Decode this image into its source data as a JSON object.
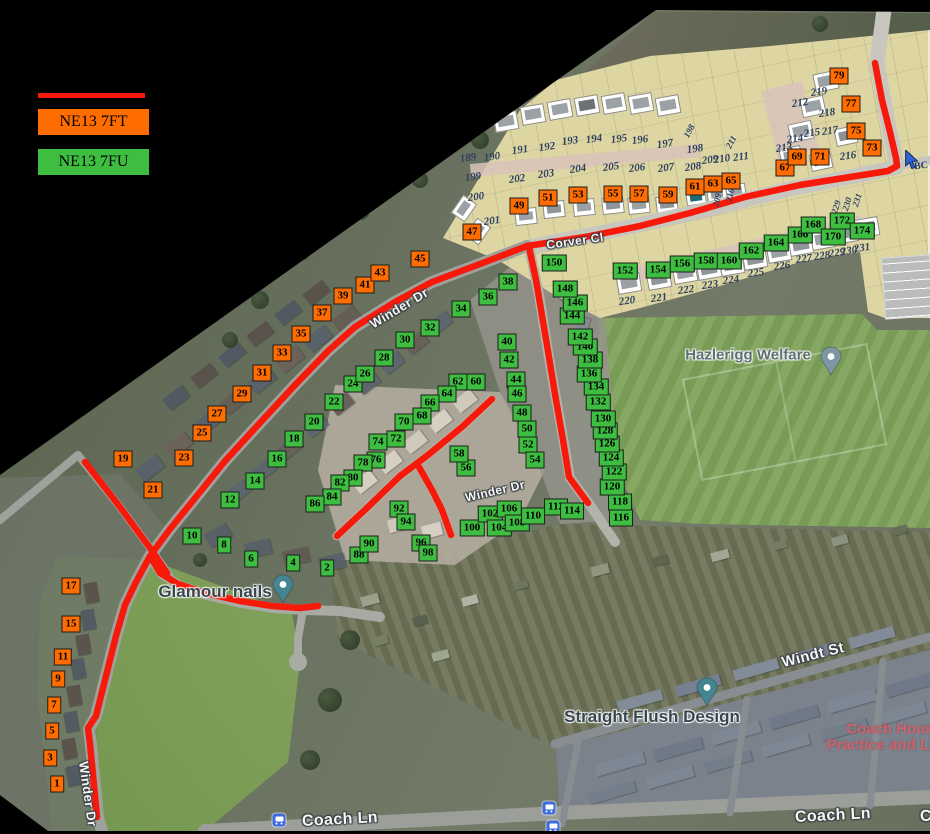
{
  "legend": {
    "route_color": "#f7190a",
    "items": [
      {
        "label": "NE13 7FT",
        "color": "#ff6d00"
      },
      {
        "label": "NE13 7FU",
        "color": "#3ebe41"
      }
    ]
  },
  "markers": {
    "groups": [
      {
        "postcode": "NE13 7FT",
        "color": "#ff6d00",
        "points": [
          [
            1,
            57,
            784
          ],
          [
            3,
            50,
            758
          ],
          [
            5,
            52,
            731
          ],
          [
            7,
            54,
            705
          ],
          [
            9,
            58,
            679
          ],
          [
            11,
            63,
            657
          ],
          [
            15,
            71,
            624
          ],
          [
            17,
            71,
            586
          ],
          [
            19,
            123,
            459
          ],
          [
            21,
            153,
            490
          ],
          [
            23,
            184,
            458
          ],
          [
            25,
            202,
            433
          ],
          [
            27,
            217,
            414
          ],
          [
            29,
            242,
            394
          ],
          [
            31,
            262,
            373
          ],
          [
            33,
            282,
            353
          ],
          [
            35,
            301,
            334
          ],
          [
            37,
            322,
            313
          ],
          [
            39,
            343,
            296
          ],
          [
            41,
            365,
            285
          ],
          [
            43,
            380,
            273
          ],
          [
            45,
            420,
            259
          ],
          [
            47,
            472,
            232
          ],
          [
            49,
            519,
            206
          ],
          [
            51,
            548,
            198
          ],
          [
            53,
            578,
            195
          ],
          [
            55,
            613,
            194
          ],
          [
            57,
            639,
            194
          ],
          [
            59,
            668,
            195
          ],
          [
            61,
            695,
            187
          ],
          [
            63,
            713,
            184
          ],
          [
            65,
            731,
            181
          ],
          [
            67,
            785,
            168
          ],
          [
            69,
            797,
            157
          ],
          [
            71,
            820,
            157
          ],
          [
            73,
            872,
            148
          ],
          [
            75,
            856,
            131
          ],
          [
            77,
            851,
            104
          ],
          [
            79,
            839,
            76
          ]
        ]
      },
      {
        "postcode": "NE13 7FU",
        "color": "#3ebe41",
        "points": [
          [
            2,
            327,
            568
          ],
          [
            4,
            293,
            563
          ],
          [
            6,
            251,
            559
          ],
          [
            8,
            224,
            545
          ],
          [
            10,
            192,
            536
          ],
          [
            12,
            230,
            500
          ],
          [
            14,
            255,
            481
          ],
          [
            16,
            277,
            459
          ],
          [
            18,
            294,
            439
          ],
          [
            20,
            314,
            422
          ],
          [
            22,
            334,
            402
          ],
          [
            24,
            353,
            384
          ],
          [
            26,
            365,
            374
          ],
          [
            28,
            384,
            358
          ],
          [
            30,
            405,
            340
          ],
          [
            32,
            430,
            328
          ],
          [
            34,
            461,
            309
          ],
          [
            36,
            488,
            297
          ],
          [
            38,
            508,
            282
          ],
          [
            40,
            507,
            342
          ],
          [
            42,
            509,
            360
          ],
          [
            44,
            516,
            380
          ],
          [
            46,
            517,
            394
          ],
          [
            48,
            522,
            413
          ],
          [
            50,
            527,
            429
          ],
          [
            52,
            528,
            445
          ],
          [
            54,
            535,
            460
          ],
          [
            56,
            466,
            468
          ],
          [
            58,
            459,
            454
          ],
          [
            60,
            476,
            382
          ],
          [
            62,
            458,
            382
          ],
          [
            64,
            447,
            394
          ],
          [
            66,
            430,
            403
          ],
          [
            68,
            422,
            416
          ],
          [
            70,
            404,
            422
          ],
          [
            72,
            396,
            439
          ],
          [
            74,
            378,
            442
          ],
          [
            76,
            376,
            460
          ],
          [
            78,
            363,
            463
          ],
          [
            80,
            353,
            478
          ],
          [
            82,
            340,
            483
          ],
          [
            84,
            332,
            497
          ],
          [
            86,
            315,
            504
          ],
          [
            88,
            359,
            555
          ],
          [
            90,
            369,
            544
          ],
          [
            92,
            399,
            509
          ],
          [
            94,
            406,
            522
          ],
          [
            96,
            421,
            543
          ],
          [
            98,
            428,
            553
          ],
          [
            100,
            472,
            528
          ],
          [
            102,
            490,
            514
          ],
          [
            104,
            499,
            528
          ],
          [
            106,
            509,
            509
          ],
          [
            108,
            517,
            523
          ],
          [
            110,
            533,
            516
          ],
          [
            112,
            556,
            507
          ],
          [
            114,
            572,
            511
          ],
          [
            116,
            621,
            518
          ],
          [
            118,
            620,
            502
          ],
          [
            120,
            612,
            487
          ],
          [
            122,
            614,
            472
          ],
          [
            124,
            611,
            458
          ],
          [
            126,
            607,
            444
          ],
          [
            128,
            605,
            431
          ],
          [
            130,
            603,
            419
          ],
          [
            132,
            598,
            402
          ],
          [
            134,
            596,
            387
          ],
          [
            136,
            589,
            374
          ],
          [
            138,
            590,
            360
          ],
          [
            140,
            585,
            347
          ],
          [
            142,
            580,
            337
          ],
          [
            144,
            572,
            316
          ],
          [
            146,
            575,
            303
          ],
          [
            148,
            565,
            289
          ],
          [
            150,
            554,
            263
          ],
          [
            152,
            625,
            271
          ],
          [
            154,
            658,
            270
          ],
          [
            156,
            682,
            264
          ],
          [
            158,
            706,
            261
          ],
          [
            160,
            729,
            261
          ],
          [
            162,
            751,
            251
          ],
          [
            164,
            776,
            243
          ],
          [
            166,
            800,
            235
          ],
          [
            168,
            813,
            225
          ],
          [
            170,
            833,
            237
          ],
          [
            172,
            842,
            221
          ],
          [
            174,
            862,
            231
          ]
        ]
      }
    ]
  },
  "site_plan": {
    "plot_numbers": [
      [
        189,
        468,
        158
      ],
      [
        190,
        492,
        157
      ],
      [
        191,
        520,
        150
      ],
      [
        192,
        547,
        147
      ],
      [
        193,
        570,
        141
      ],
      [
        194,
        594,
        139
      ],
      [
        195,
        619,
        139
      ],
      [
        196,
        640,
        140
      ],
      [
        197,
        665,
        144
      ],
      [
        198,
        695,
        149
      ],
      [
        199,
        473,
        177
      ],
      [
        200,
        476,
        197
      ],
      [
        201,
        492,
        221
      ],
      [
        202,
        517,
        179
      ],
      [
        203,
        546,
        174
      ],
      [
        204,
        578,
        169
      ],
      [
        205,
        611,
        167
      ],
      [
        206,
        637,
        168
      ],
      [
        207,
        666,
        168
      ],
      [
        208,
        693,
        167
      ],
      [
        209,
        710,
        160
      ],
      [
        210,
        722,
        159
      ],
      [
        211,
        741,
        157
      ],
      [
        212,
        800,
        103
      ],
      [
        213,
        784,
        148
      ],
      [
        214,
        795,
        139
      ],
      [
        215,
        812,
        133
      ],
      [
        216,
        848,
        156
      ],
      [
        217,
        830,
        131
      ],
      [
        218,
        827,
        113
      ],
      [
        219,
        819,
        92
      ],
      [
        220,
        627,
        301
      ],
      [
        221,
        659,
        298
      ],
      [
        222,
        686,
        290
      ],
      [
        223,
        710,
        285
      ],
      [
        224,
        731,
        280
      ],
      [
        225,
        756,
        273
      ],
      [
        226,
        782,
        266
      ],
      [
        227,
        804,
        259
      ],
      [
        228,
        822,
        256
      ],
      [
        229,
        837,
        253
      ],
      [
        230,
        849,
        251
      ],
      [
        231,
        862,
        248
      ]
    ],
    "rotated_plot_numbers": [
      [
        198,
        689,
        131,
        -62
      ],
      [
        211,
        731,
        142,
        -62
      ],
      [
        209,
        717,
        200,
        -78
      ],
      [
        210,
        730,
        195,
        -78
      ],
      [
        229,
        836,
        207,
        -72
      ],
      [
        230,
        847,
        204,
        -72
      ],
      [
        231,
        857,
        200,
        -72
      ]
    ]
  },
  "street_labels": [
    {
      "text": "Winder Dr",
      "x": 399,
      "y": 308,
      "rot": -31,
      "size": 13
    },
    {
      "text": "Winder Dr",
      "x": 495,
      "y": 491,
      "rot": -13,
      "size": 12
    },
    {
      "text": "Winder Dr",
      "x": 88,
      "y": 794,
      "rot": 82,
      "size": 13
    },
    {
      "text": "Corver Cl",
      "x": 575,
      "y": 241,
      "rot": -8,
      "size": 12
    },
    {
      "text": "Windt St",
      "x": 813,
      "y": 655,
      "rot": -14,
      "size": 15
    },
    {
      "text": "Coach Ln",
      "x": 340,
      "y": 820,
      "rot": -3,
      "size": 16
    },
    {
      "text": "Coach Ln",
      "x": 833,
      "y": 816,
      "rot": -3,
      "size": 16
    },
    {
      "text": "C",
      "x": 926,
      "y": 817,
      "rot": -3,
      "size": 16
    }
  ],
  "pois": [
    {
      "name": "glamour-nails",
      "text": "Glamour nails",
      "x": 215,
      "y": 592,
      "size": 17,
      "style": "dark",
      "pin": {
        "x": 283,
        "y": 603,
        "color": "#44858f"
      }
    },
    {
      "name": "hazlerigg-welfare",
      "text": "Hazlerigg Welfare",
      "x": 748,
      "y": 355,
      "size": 15,
      "style": "grey",
      "pin": {
        "x": 831,
        "y": 375,
        "color": "#7e95a3"
      }
    },
    {
      "name": "straight-flush-design",
      "text": "Straight Flush Design",
      "x": 652,
      "y": 717,
      "size": 17,
      "style": "dark",
      "pin": {
        "x": 707,
        "y": 706,
        "color": "#44858f"
      }
    },
    {
      "name": "coach-house-practice-line1",
      "text": "Coach Hous",
      "x": 890,
      "y": 729,
      "size": 15,
      "style": "pink"
    },
    {
      "name": "coach-house-practice-line2",
      "text": "Practice and La",
      "x": 882,
      "y": 745,
      "size": 15,
      "style": "pink"
    }
  ],
  "bus_stops": [
    [
      279,
      820
    ],
    [
      549,
      808
    ],
    [
      553,
      827
    ]
  ],
  "map_edge_label": {
    "text": "BC",
    "x": 921,
    "y": 166
  },
  "cursor": {
    "x": 903,
    "y": 150
  },
  "routes": {
    "color": "#f7190a",
    "width": 6.5,
    "lines": [
      {
        "name": "corver-top",
        "points": [
          [
            875,
            63
          ],
          [
            882,
            100
          ],
          [
            890,
            132
          ],
          [
            896,
            158
          ],
          [
            897,
            166
          ],
          [
            888,
            171
          ],
          [
            850,
            177
          ],
          [
            800,
            185
          ],
          [
            745,
            197
          ],
          [
            690,
            213
          ],
          [
            640,
            226
          ],
          [
            585,
            237
          ],
          [
            527,
            246
          ]
        ]
      },
      {
        "name": "corver-down",
        "points": [
          [
            529,
            247
          ],
          [
            536,
            280
          ],
          [
            547,
            345
          ],
          [
            556,
            400
          ],
          [
            563,
            440
          ],
          [
            569,
            477
          ],
          [
            588,
            503
          ]
        ]
      },
      {
        "name": "winder-main",
        "points": [
          [
            527,
            246
          ],
          [
            480,
            264
          ],
          [
            432,
            282
          ],
          [
            395,
            302
          ],
          [
            355,
            327
          ],
          [
            328,
            351
          ],
          [
            295,
            385
          ],
          [
            258,
            425
          ],
          [
            225,
            461
          ],
          [
            196,
            497
          ],
          [
            170,
            529
          ],
          [
            150,
            556
          ]
        ]
      },
      {
        "name": "glamour-curve",
        "points": [
          [
            150,
            556
          ],
          [
            160,
            573
          ],
          [
            178,
            584
          ],
          [
            205,
            593
          ],
          [
            240,
            601
          ],
          [
            272,
            606
          ],
          [
            300,
            608
          ],
          [
            318,
            606
          ]
        ]
      },
      {
        "name": "winder-south",
        "points": [
          [
            150,
            556
          ],
          [
            136,
            582
          ],
          [
            125,
            605
          ],
          [
            116,
            636
          ],
          [
            106,
            676
          ],
          [
            96,
            716
          ],
          [
            88,
            728
          ],
          [
            90,
            744
          ],
          [
            93,
            775
          ],
          [
            97,
            817
          ]
        ]
      },
      {
        "name": "cross-spur",
        "points": [
          [
            85,
            462
          ],
          [
            120,
            507
          ],
          [
            150,
            548
          ],
          [
            167,
            573
          ]
        ]
      },
      {
        "name": "estate-spine",
        "points": [
          [
            492,
            399
          ],
          [
            462,
            427
          ],
          [
            428,
            455
          ],
          [
            400,
            476
          ],
          [
            368,
            507
          ],
          [
            337,
            536
          ]
        ]
      },
      {
        "name": "estate-branch",
        "points": [
          [
            419,
            467
          ],
          [
            432,
            490
          ],
          [
            442,
            510
          ],
          [
            451,
            535
          ]
        ]
      }
    ]
  }
}
